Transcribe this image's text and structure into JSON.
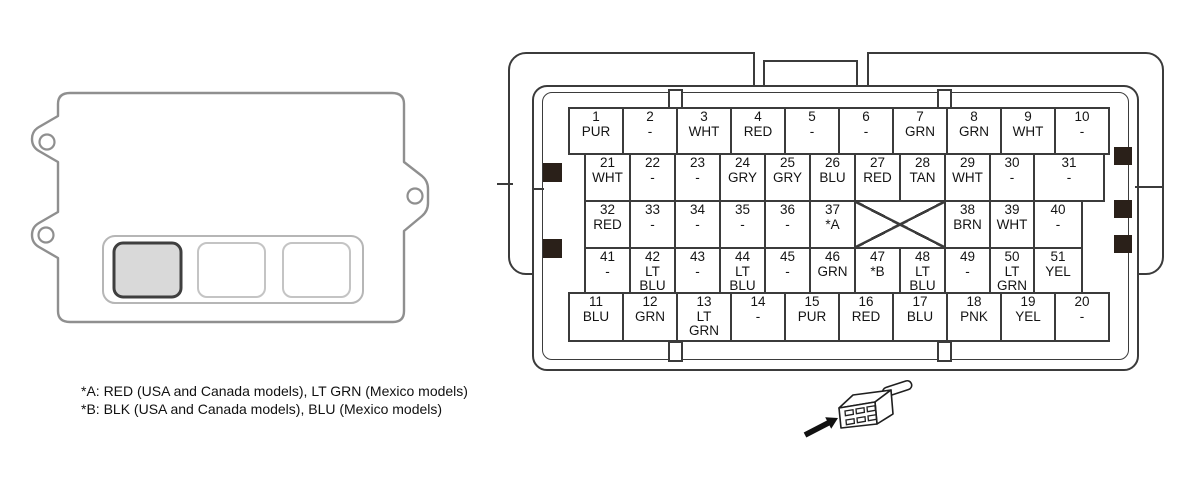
{
  "connector_pinout": {
    "rows": [
      {
        "pins": [
          {
            "num": "1",
            "color": "PUR"
          },
          {
            "num": "2",
            "color": "-"
          },
          {
            "num": "3",
            "color": "WHT"
          },
          {
            "num": "4",
            "color": "RED"
          },
          {
            "num": "5",
            "color": "-"
          },
          {
            "num": "6",
            "color": "-"
          },
          {
            "num": "7",
            "color": "GRN"
          },
          {
            "num": "8",
            "color": "GRN"
          },
          {
            "num": "9",
            "color": "WHT"
          },
          {
            "num": "10",
            "color": "-"
          }
        ]
      },
      {
        "pins": [
          {
            "num": "21",
            "color": "WHT"
          },
          {
            "num": "22",
            "color": "-"
          },
          {
            "num": "23",
            "color": "-"
          },
          {
            "num": "24",
            "color": "GRY"
          },
          {
            "num": "25",
            "color": "GRY"
          },
          {
            "num": "26",
            "color": "BLU"
          },
          {
            "num": "27",
            "color": "RED"
          },
          {
            "num": "28",
            "color": "TAN"
          },
          {
            "num": "29",
            "color": "WHT"
          },
          {
            "num": "30",
            "color": "-"
          },
          {
            "num": "31",
            "color": "-"
          }
        ]
      },
      {
        "pins": [
          {
            "num": "32",
            "color": "RED"
          },
          {
            "num": "33",
            "color": "-"
          },
          {
            "num": "34",
            "color": "-"
          },
          {
            "num": "35",
            "color": "-"
          },
          {
            "num": "36",
            "color": "-"
          },
          {
            "num": "37",
            "color": "*A"
          },
          {
            "blocked": true
          },
          {
            "num": "38",
            "color": "BRN"
          },
          {
            "num": "39",
            "color": "WHT"
          },
          {
            "num": "40",
            "color": "-"
          }
        ]
      },
      {
        "pins": [
          {
            "num": "41",
            "color": "-"
          },
          {
            "num": "42",
            "color": "LT\nBLU"
          },
          {
            "num": "43",
            "color": "-"
          },
          {
            "num": "44",
            "color": "LT\nBLU"
          },
          {
            "num": "45",
            "color": "-"
          },
          {
            "num": "46",
            "color": "GRN"
          },
          {
            "num": "47",
            "color": "*B"
          },
          {
            "num": "48",
            "color": "LT\nBLU"
          },
          {
            "num": "49",
            "color": "-"
          },
          {
            "num": "50",
            "color": "LT\nGRN"
          },
          {
            "num": "51",
            "color": "YEL"
          }
        ]
      },
      {
        "pins": [
          {
            "num": "11",
            "color": "BLU"
          },
          {
            "num": "12",
            "color": "GRN"
          },
          {
            "num": "13",
            "color": "LT\nGRN"
          },
          {
            "num": "14",
            "color": "-"
          },
          {
            "num": "15",
            "color": "PUR"
          },
          {
            "num": "16",
            "color": "RED"
          },
          {
            "num": "17",
            "color": "BLU"
          },
          {
            "num": "18",
            "color": "PNK"
          },
          {
            "num": "19",
            "color": "YEL"
          },
          {
            "num": "20",
            "color": "-"
          }
        ]
      }
    ]
  },
  "notes": {
    "line_a": "*A: RED (USA and Canada models), LT GRN (Mexico models)",
    "line_b": "*B: BLK (USA and Canada models), BLU (Mexico models)"
  },
  "colors": {
    "line_dark": "#3b3b3b",
    "module_outline": "#8f8f8f",
    "highlight_fill": "#d9d9d9",
    "key_block": "#2a2019"
  }
}
